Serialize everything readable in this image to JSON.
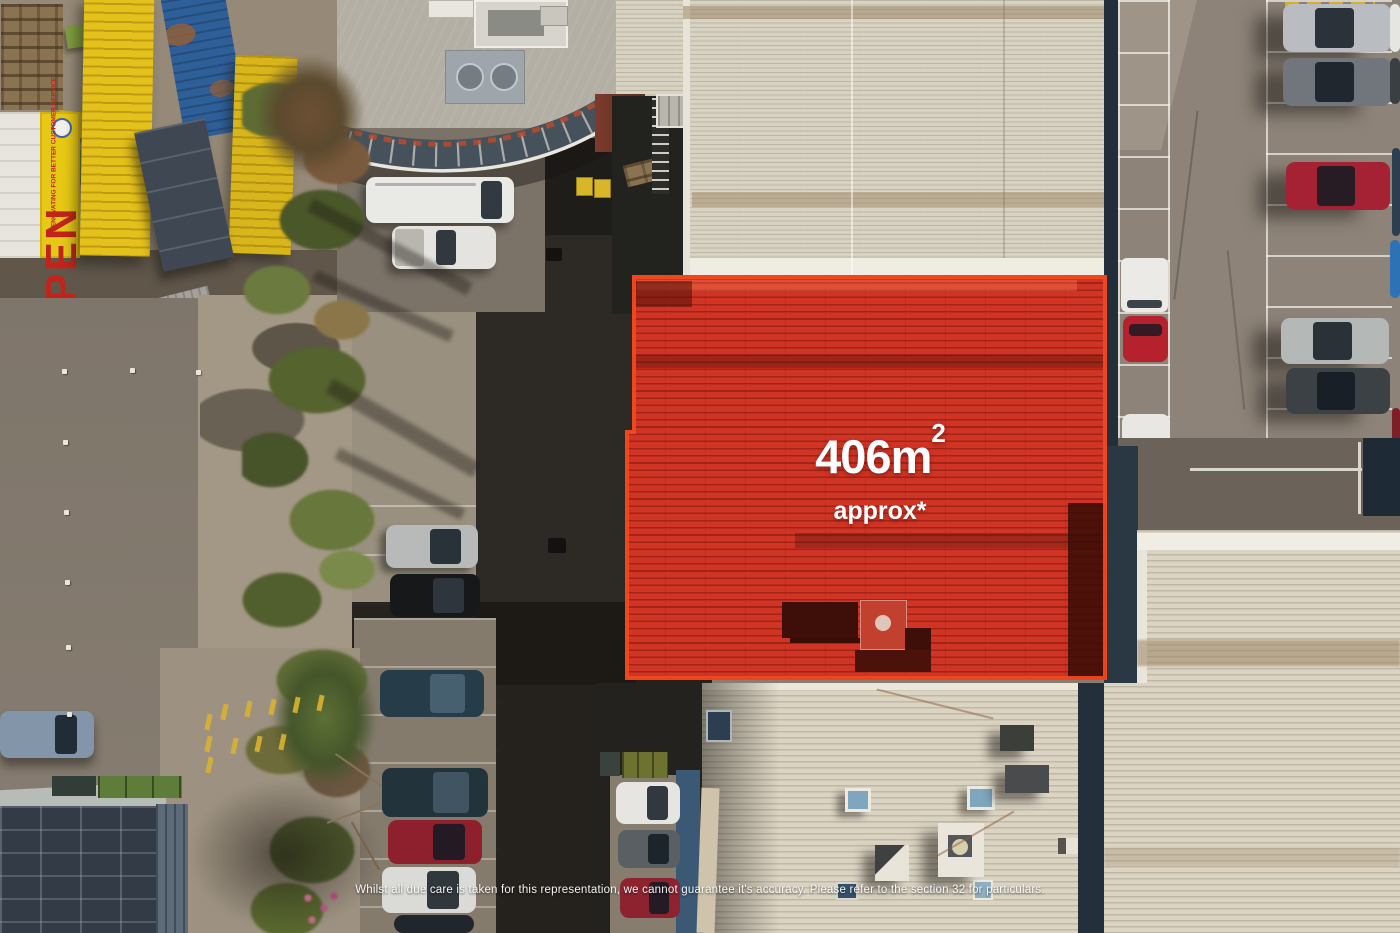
{
  "overlay": {
    "area_value": "406m",
    "area_sup": "2",
    "approx_label": "approx*",
    "highlight_fill_color": "#cf3424",
    "highlight_border_color": "#f2481f",
    "label_text_color": "#ffffff"
  },
  "footer": {
    "disclaimer": "Whilst all due care is taken for this representation, we cannot guarantee it's accuracy. Please refer to the section 32 for particulars."
  },
  "signage": {
    "open_sign_title": "OPEN",
    "open_sign_subtitle": "RENOVATING FOR BETTER CUSTOMER SERVICE"
  }
}
